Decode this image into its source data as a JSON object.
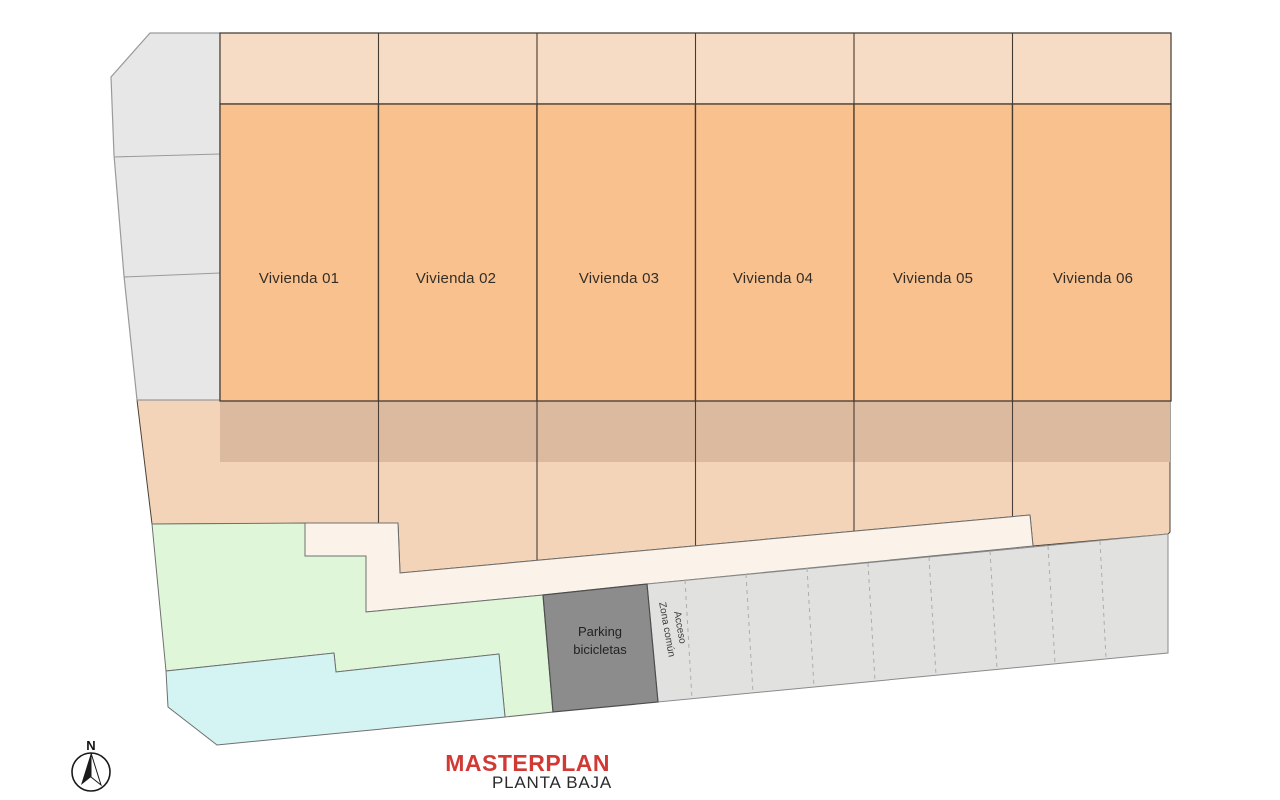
{
  "plan": {
    "units": [
      {
        "label": "Vivienda 01"
      },
      {
        "label": "Vivienda 02"
      },
      {
        "label": "Vivienda 03"
      },
      {
        "label": "Vivienda 04"
      },
      {
        "label": "Vivienda 05"
      },
      {
        "label": "Vivienda 06"
      }
    ],
    "bike_parking": {
      "line1": "Parking",
      "line2": "bicicletas"
    },
    "access_zone": {
      "line1": "Acceso",
      "line2": "Zona común"
    }
  },
  "titleblock": {
    "title": "MASTERPLAN",
    "subtitle": "PLANTA BAJA"
  },
  "compass": {
    "north_label": "N"
  },
  "colors": {
    "unit_fill": "#f9c18d",
    "top_strip_fill": "#f6dcc5",
    "garden_fill": "#f3d4b8",
    "terrace_band_fill": "#dbbaa0",
    "path_fill": "#fbf3ea",
    "green_zone_fill": "#dff7d8",
    "pool_zone_fill": "#d3f4f3",
    "side_strip_fill": "#e7e7e7",
    "parking_fill": "#e1e1e0",
    "bike_parking_fill": "#8c8c8c",
    "line_dark": "#44403a",
    "text_dark": "#332e28",
    "title_red": "#d13a34",
    "subtitle_dark": "#2b2b2b"
  }
}
